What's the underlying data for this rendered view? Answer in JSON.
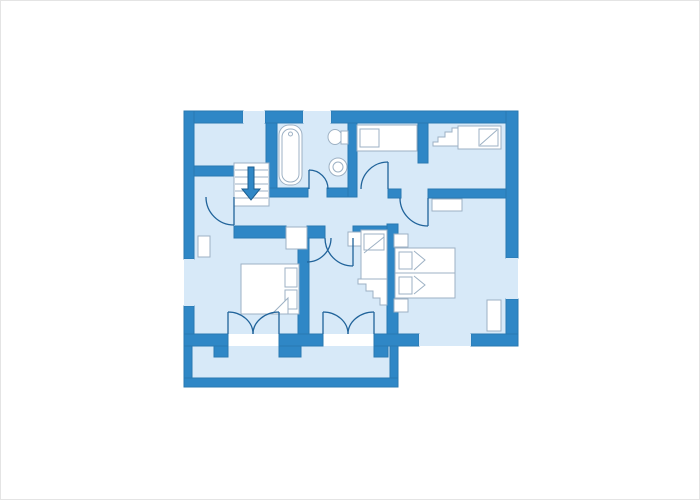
{
  "image_type": "apartment-floor-plan",
  "plan": {
    "colors": {
      "background": "#ffffff",
      "wall": "#2f87c6",
      "wall_edge": "#2979b2",
      "floor": "#d7e9f8",
      "furniture_fill": "#ffffff",
      "furniture_stroke": "#9db1c4",
      "door_arc": "#20639a",
      "arrow": "#2f87c6",
      "arrow_edge": "#1d5e8f",
      "frame_border": "#e4e4e4"
    },
    "floors": [
      {
        "name": "main-floor",
        "x": 193,
        "y": 122,
        "w": 312,
        "h": 211
      },
      {
        "name": "balcony-floor",
        "x": 191,
        "y": 345,
        "w": 198,
        "h": 32
      }
    ],
    "window_gaps": [
      {
        "name": "window-top-1",
        "x": 242,
        "y": 110,
        "w": 22,
        "h": 12
      },
      {
        "name": "window-top-2",
        "x": 302,
        "y": 110,
        "w": 28,
        "h": 12
      },
      {
        "name": "window-left",
        "x": 183,
        "y": 258,
        "w": 10,
        "h": 47
      },
      {
        "name": "window-right",
        "x": 505,
        "y": 257,
        "w": 12,
        "h": 41
      },
      {
        "name": "window-bottom",
        "x": 418,
        "y": 333,
        "w": 52,
        "h": 12
      }
    ],
    "walls": [
      {
        "name": "top-wall-a",
        "x": 183,
        "y": 110,
        "w": 59,
        "h": 12
      },
      {
        "name": "top-wall-b",
        "x": 264,
        "y": 110,
        "w": 38,
        "h": 12
      },
      {
        "name": "top-wall-c",
        "x": 330,
        "y": 110,
        "w": 187,
        "h": 12
      },
      {
        "name": "left-wall-a",
        "x": 183,
        "y": 110,
        "w": 10,
        "h": 148
      },
      {
        "name": "left-wall-b",
        "x": 183,
        "y": 305,
        "w": 10,
        "h": 40
      },
      {
        "name": "right-wall-a",
        "x": 505,
        "y": 110,
        "w": 12,
        "h": 147
      },
      {
        "name": "right-wall-b",
        "x": 505,
        "y": 298,
        "w": 12,
        "h": 47
      },
      {
        "name": "bottom-wall-a",
        "x": 183,
        "y": 333,
        "w": 44,
        "h": 12
      },
      {
        "name": "bottom-wall-b",
        "x": 278,
        "y": 333,
        "w": 44,
        "h": 12
      },
      {
        "name": "bottom-wall-c",
        "x": 373,
        "y": 333,
        "w": 45,
        "h": 12
      },
      {
        "name": "bottom-wall-d",
        "x": 470,
        "y": 333,
        "w": 47,
        "h": 12
      },
      {
        "name": "door-jamb-a",
        "x": 213,
        "y": 345,
        "w": 14,
        "h": 11
      },
      {
        "name": "door-jamb-b",
        "x": 278,
        "y": 345,
        "w": 22,
        "h": 11
      },
      {
        "name": "door-jamb-c",
        "x": 373,
        "y": 345,
        "w": 14,
        "h": 11
      },
      {
        "name": "room1-bottom-wall",
        "x": 193,
        "y": 165,
        "w": 40,
        "h": 10
      },
      {
        "name": "bath-left-wall",
        "x": 265,
        "y": 122,
        "w": 11,
        "h": 68
      },
      {
        "name": "bath-bottom-wall-a",
        "x": 268,
        "y": 187,
        "w": 39,
        "h": 9
      },
      {
        "name": "bath-bottom-wall-b",
        "x": 326,
        "y": 187,
        "w": 21,
        "h": 9
      },
      {
        "name": "bath-right-wall",
        "x": 347,
        "y": 122,
        "w": 9,
        "h": 74
      },
      {
        "name": "room2-bottom-wall",
        "x": 387,
        "y": 188,
        "w": 13,
        "h": 9
      },
      {
        "name": "bedroom3-top-wall",
        "x": 427,
        "y": 188,
        "w": 78,
        "h": 9
      },
      {
        "name": "toprooms-divider-wall",
        "x": 417,
        "y": 122,
        "w": 10,
        "h": 40
      },
      {
        "name": "hall-wall-a",
        "x": 233,
        "y": 225,
        "w": 52,
        "h": 12
      },
      {
        "name": "hall-wall-b",
        "x": 306,
        "y": 225,
        "w": 18,
        "h": 12
      },
      {
        "name": "hall-wall-c",
        "x": 352,
        "y": 225,
        "w": 34,
        "h": 12
      },
      {
        "name": "bedroom1-right-wall",
        "x": 297,
        "y": 237,
        "w": 11,
        "h": 96
      },
      {
        "name": "bedroom2-right-wall",
        "x": 386,
        "y": 223,
        "w": 11,
        "h": 110
      },
      {
        "name": "balcony-left-wall",
        "x": 183,
        "y": 345,
        "w": 8,
        "h": 41
      },
      {
        "name": "balcony-right-wall",
        "x": 389,
        "y": 345,
        "w": 8,
        "h": 41
      },
      {
        "name": "balcony-bottom-wall",
        "x": 183,
        "y": 377,
        "w": 214,
        "h": 9
      }
    ],
    "stairs": {
      "box": {
        "x": 233,
        "y": 162,
        "w": 35,
        "h": 43
      },
      "tread_ys": [
        169,
        176,
        183,
        190,
        197
      ],
      "arrow_points": "247,166 253,166 253,188 259,188 250,199 241,188 247,188"
    },
    "furniture": [
      {
        "name": "bathtub",
        "t": "rrect",
        "x": 278,
        "y": 124,
        "w": 23,
        "h": 60,
        "r": 10
      },
      {
        "name": "bathtub-inner",
        "t": "rrect",
        "x": 281,
        "y": 128,
        "w": 17,
        "h": 53,
        "r": 8
      },
      {
        "name": "bathtub-faucet",
        "t": "circle",
        "cx": 289.5,
        "cy": 133,
        "r": 2
      },
      {
        "name": "toilet-bowl",
        "t": "ellipse",
        "cx": 334,
        "cy": 136,
        "rx": 7,
        "ry": 7.5
      },
      {
        "name": "toilet-tank",
        "t": "rect",
        "x": 340,
        "y": 130,
        "w": 7,
        "h": 13
      },
      {
        "name": "sink",
        "t": "circle",
        "cx": 337,
        "cy": 166,
        "r": 9
      },
      {
        "name": "sink-inner",
        "t": "circle",
        "cx": 337,
        "cy": 166,
        "r": 5
      },
      {
        "name": "bed-room2",
        "t": "rect",
        "x": 356,
        "y": 124,
        "w": 60,
        "h": 26
      },
      {
        "name": "bed-room2-pillow",
        "t": "rect",
        "x": 359,
        "y": 128,
        "w": 19,
        "h": 18
      },
      {
        "name": "bed-room3",
        "t": "rect",
        "x": 457,
        "y": 125,
        "w": 43,
        "h": 23
      },
      {
        "name": "bed-room3-pillow",
        "t": "rect",
        "x": 478,
        "y": 128,
        "w": 19,
        "h": 17
      },
      {
        "name": "bed-room3-pillow-fold",
        "t": "line",
        "x1": 479,
        "y1": 144,
        "x2": 496,
        "y2": 129
      },
      {
        "name": "bed-room3-steps",
        "t": "polygon",
        "pts": "432,145 432,141 437,141 437,136 444,136 444,131 451,131 451,127 457,127 457,145"
      },
      {
        "name": "shelf-bedroom3",
        "t": "rect",
        "x": 431,
        "y": 198,
        "w": 30,
        "h": 12
      },
      {
        "name": "twin-bed-1",
        "t": "rect",
        "x": 394,
        "y": 247,
        "w": 60,
        "h": 25
      },
      {
        "name": "twin-bed-1-pillow",
        "t": "rect",
        "x": 398,
        "y": 251,
        "w": 13,
        "h": 17
      },
      {
        "name": "twin-bed-1-fold",
        "t": "polyline",
        "pts": "413,250 424,259 413,269"
      },
      {
        "name": "twin-bed-2",
        "t": "rect",
        "x": 394,
        "y": 272,
        "w": 60,
        "h": 25
      },
      {
        "name": "twin-bed-2-pillow",
        "t": "rect",
        "x": 398,
        "y": 276,
        "w": 13,
        "h": 17
      },
      {
        "name": "twin-bed-2-fold",
        "t": "polyline",
        "pts": "413,275 424,284 413,293"
      },
      {
        "name": "nightstand-top",
        "t": "rect",
        "x": 393,
        "y": 233,
        "w": 14,
        "h": 13
      },
      {
        "name": "nightstand-bottom",
        "t": "rect",
        "x": 393,
        "y": 298,
        "w": 14,
        "h": 13
      },
      {
        "name": "window-sill-right",
        "t": "rect",
        "x": 486,
        "y": 299,
        "w": 14,
        "h": 31
      },
      {
        "name": "bunk-nightstand",
        "t": "rect",
        "x": 347,
        "y": 231,
        "w": 13,
        "h": 14
      },
      {
        "name": "bunk-bed",
        "t": "rect",
        "x": 360,
        "y": 229,
        "w": 26,
        "h": 49
      },
      {
        "name": "bunk-bed-pillow",
        "t": "rect",
        "x": 363,
        "y": 233,
        "w": 20,
        "h": 16
      },
      {
        "name": "bunk-bed-fold",
        "t": "line",
        "x1": 363,
        "y1": 252,
        "x2": 383,
        "y2": 236
      },
      {
        "name": "bunk-bed-steps",
        "t": "polygon",
        "pts": "357,278 386,278 386,304 379,304 379,297 372,297 372,290 365,290 365,283 357,283"
      },
      {
        "name": "double-bed",
        "t": "rect",
        "x": 240,
        "y": 263,
        "w": 58,
        "h": 50
      },
      {
        "name": "double-bed-pillow-1",
        "t": "rect",
        "x": 284,
        "y": 267,
        "w": 12,
        "h": 19
      },
      {
        "name": "double-bed-pillow-2",
        "t": "rect",
        "x": 284,
        "y": 289,
        "w": 12,
        "h": 19
      },
      {
        "name": "double-bed-fold",
        "t": "polygon",
        "pts": "271,313 287,297 287,313"
      },
      {
        "name": "window-sill-left",
        "t": "rect",
        "x": 197,
        "y": 235,
        "w": 12,
        "h": 21
      },
      {
        "name": "doorway-bedroom1",
        "t": "rect",
        "x": 285,
        "y": 226,
        "w": 21,
        "h": 22
      }
    ],
    "doors": [
      {
        "name": "hall-door-leaf",
        "d": "M233,196 L233,224"
      },
      {
        "name": "hall-door-arc",
        "d": "M205,196 A28,28 0 0 0 233,224"
      },
      {
        "name": "bath-door-leaf",
        "d": "M308,169 L308,188"
      },
      {
        "name": "bath-door-arc",
        "d": "M308,169 A19,19 0 0 1 327,188"
      },
      {
        "name": "room2-door-leaf",
        "d": "M387,161 L387,188"
      },
      {
        "name": "room2-door-arc",
        "d": "M387,161 A27,27 0 0 0 360,188"
      },
      {
        "name": "bedroom3-door-leaf",
        "d": "M427,197 L427,225"
      },
      {
        "name": "bedroom3-door-arc",
        "d": "M399,197 A28,28 0 0 0 427,225"
      },
      {
        "name": "middle-room-door-leaf",
        "d": "M352,237 L352,265"
      },
      {
        "name": "middle-room-door-arc",
        "d": "M324,237 A28,28 0 0 0 352,265"
      },
      {
        "name": "bedroom1-door-arc",
        "d": "M306,261 A24,24 0 0 0 330,237"
      },
      {
        "name": "french-door-1-left-leaf",
        "d": "M227,333 L227,311"
      },
      {
        "name": "french-door-1-left-arc",
        "d": "M227,311 A25,22 0 0 1 252,333"
      },
      {
        "name": "french-door-1-right-leaf",
        "d": "M278,333 L278,311"
      },
      {
        "name": "french-door-1-right-arc",
        "d": "M278,311 A26,22 0 0 0 252,333"
      },
      {
        "name": "french-door-2-left-leaf",
        "d": "M322,333 L322,311"
      },
      {
        "name": "french-door-2-left-arc",
        "d": "M322,311 A25,22 0 0 1 347,333"
      },
      {
        "name": "french-door-2-right-leaf",
        "d": "M373,333 L373,311"
      },
      {
        "name": "french-door-2-right-arc",
        "d": "M373,311 A26,22 0 0 0 347,333"
      }
    ]
  }
}
